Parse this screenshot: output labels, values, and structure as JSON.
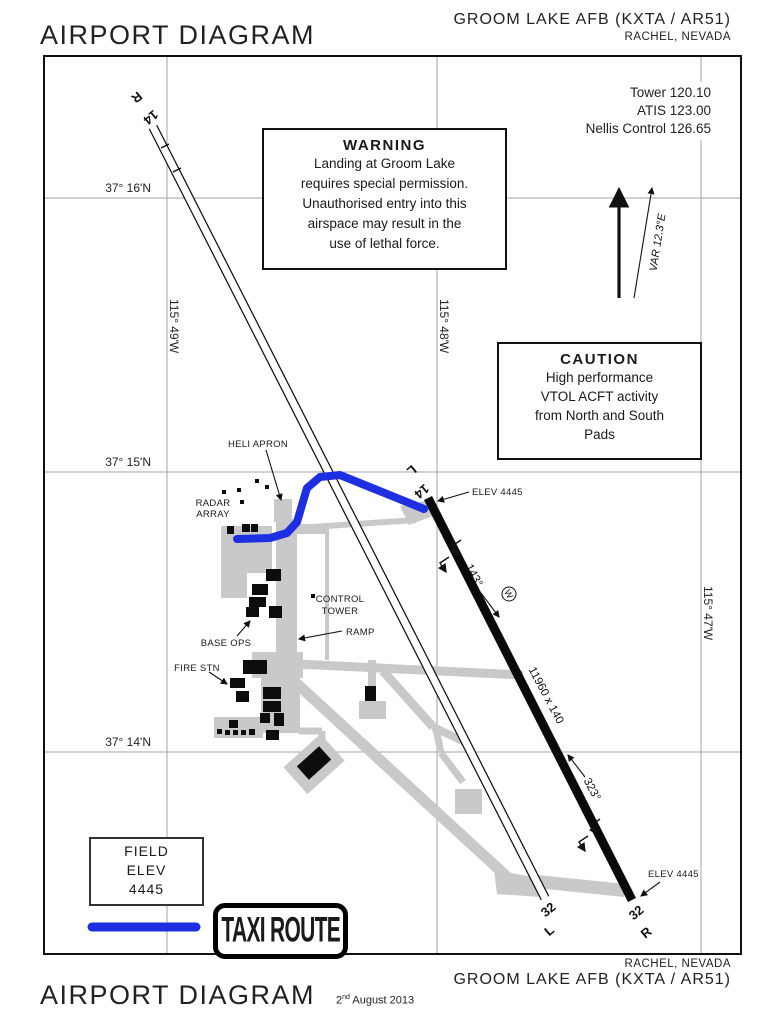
{
  "header": {
    "title": "AIRPORT DIAGRAM",
    "airport": "GROOM LAKE AFB (KXTA / AR51)",
    "location": "RACHEL, NEVADA"
  },
  "frequencies": {
    "tower": "Tower 120.10",
    "atis": "ATIS 123.00",
    "nellis": "Nellis Control 126.65"
  },
  "warning_box": {
    "title": "WARNING",
    "lines": [
      "Landing at Groom Lake",
      "requires special permission.",
      "Unauthorised entry into this",
      "airspace may result in the",
      "use of lethal force."
    ]
  },
  "caution_box": {
    "title": "CAUTION",
    "lines": [
      "High performance",
      "VTOL ACFT activity",
      "from North and South",
      "Pads"
    ]
  },
  "grid": {
    "lat": [
      "37° 16'N",
      "37° 15'N",
      "37° 14'N"
    ],
    "lon": [
      "115° 49'W",
      "115° 48'W",
      "115° 47'W"
    ]
  },
  "map_labels": {
    "heli_apron": "HELI APRON",
    "radar_1": "RADAR",
    "radar_2": "ARRAY",
    "control_1": "CONTROL",
    "control_2": "TOWER",
    "base_ops": "BASE OPS",
    "ramp": "RAMP",
    "fire_stn": "FIRE STN",
    "elev_14l": "ELEV 4445",
    "elev_32r": "ELEV 4445",
    "var": "VAR 12.3°E",
    "w_symbol": "W"
  },
  "runways": {
    "r14r_num": "14",
    "r14r_side": "R",
    "r14l_num": "14",
    "r14l_side": "L",
    "r32l_num": "32",
    "r32l_side": "L",
    "r32r_num": "32",
    "r32r_side": "R",
    "dimensions": "11960 x 140",
    "hdg_14": "143°",
    "hdg_32": "323°"
  },
  "field_elev_box": {
    "lines": [
      "FIELD",
      "ELEV",
      "4445"
    ]
  },
  "legend": {
    "label": "TAXI ROUTE",
    "color": "#1d2fe0"
  },
  "colors": {
    "taxi_route_blue": "#1d2fe0",
    "apron_gray": "#c9c9c9"
  },
  "footer": {
    "title": "AIRPORT DIAGRAM",
    "date_num": "2",
    "date_sup": "nd",
    "date_rest": " August 2013",
    "location": "RACHEL, NEVADA",
    "airport": "GROOM LAKE AFB (KXTA / AR51)"
  }
}
